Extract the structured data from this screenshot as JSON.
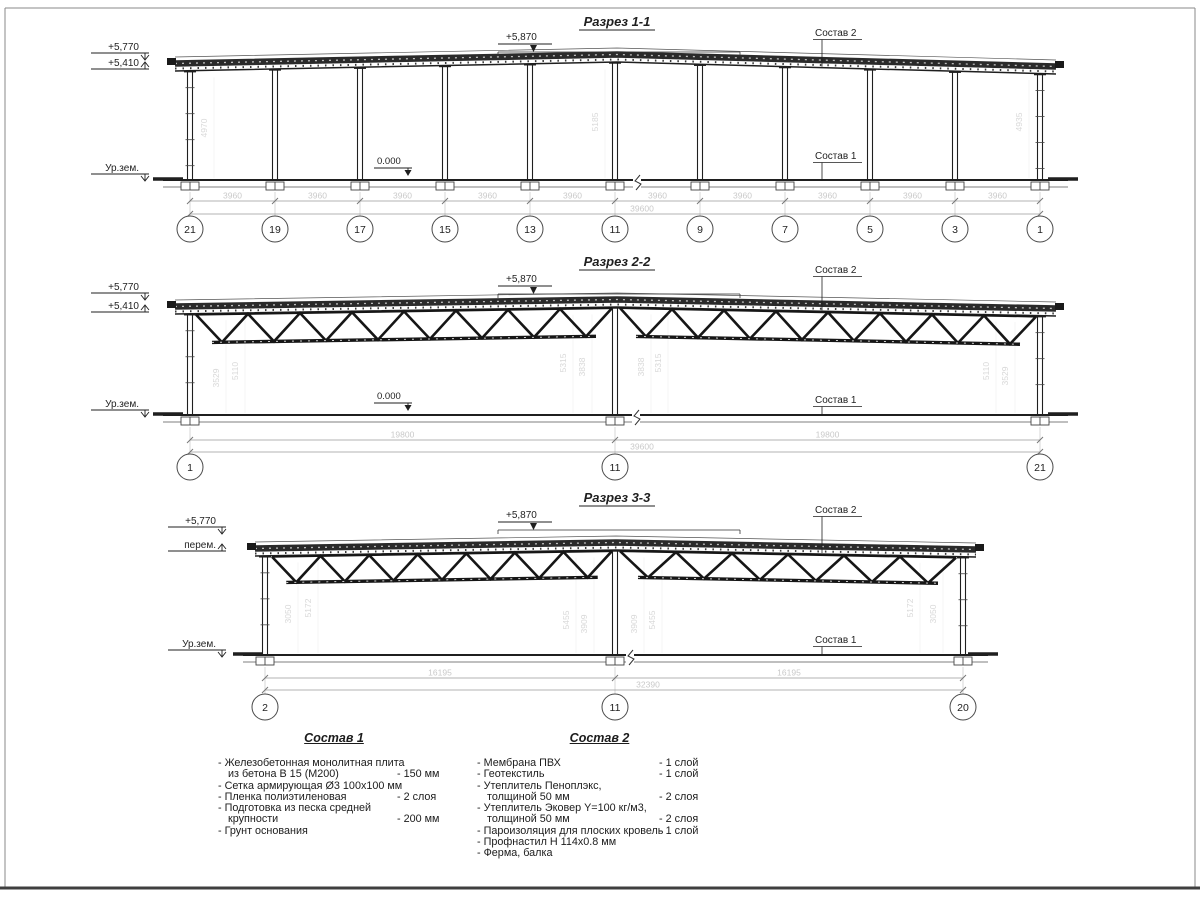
{
  "sheet": {
    "ink": "#1f1f1f",
    "faint": "#c9c9c9",
    "dim_line": "#9a9a9a",
    "background": "#ffffff"
  },
  "sections": [
    {
      "title": "Разрез 1-1",
      "elevations": {
        "top": "+5,770",
        "mid": "+5,410",
        "peak": "+5,870",
        "ground": "Ур.зем.",
        "zero": "0.000"
      },
      "callouts": {
        "roof": "Состав 2",
        "floor": "Состав 1"
      },
      "span_dims": [
        "3960",
        "3960",
        "3960",
        "3960",
        "3960",
        "3960",
        "3960",
        "3960",
        "3960",
        "3960"
      ],
      "total_dim": "39600",
      "height_dims": [
        "4970",
        "5185",
        "4935"
      ],
      "axes": [
        "21",
        "19",
        "17",
        "15",
        "13",
        "11",
        "9",
        "7",
        "5",
        "3",
        "1"
      ]
    },
    {
      "title": "Разрез 2-2",
      "elevations": {
        "top": "+5,770",
        "mid": "+5,410",
        "peak": "+5,870",
        "ground": "Ур.зем.",
        "zero": "0.000"
      },
      "callouts": {
        "roof": "Состав 2",
        "floor": "Состав 1"
      },
      "span_dims": [
        "19800",
        "19800"
      ],
      "total_dim": "39600",
      "height_dims": [
        "3529",
        "5110",
        "5315",
        "3838",
        "3838",
        "5315",
        "5110",
        "3529"
      ],
      "axes": [
        "1",
        "11",
        "21"
      ]
    },
    {
      "title": "Разрез 3-3",
      "elevations": {
        "top": "+5,770",
        "mid": "перем.",
        "peak": "+5,870",
        "ground": "Ур.зем.",
        "zero": ""
      },
      "callouts": {
        "roof": "Состав 2",
        "floor": "Состав 1"
      },
      "span_dims": [
        "16195",
        "16195"
      ],
      "total_dim": "32390",
      "height_dims": [
        "3050",
        "5172",
        "5455",
        "3909",
        "3909",
        "5455",
        "5172",
        "3050"
      ],
      "axes": [
        "2",
        "11",
        "20"
      ]
    }
  ],
  "compositions": [
    {
      "title": "Состав 1",
      "lines": [
        {
          "text": "- Железобетонная  монолитная плита",
          "value": "",
          "cont": false
        },
        {
          "text": "из бетона В 15 (М200)",
          "value": "- 150 мм",
          "cont": true
        },
        {
          "text": "- Сетка армирующая Ø3 100х100 мм",
          "value": "",
          "cont": false
        },
        {
          "text": "- Пленка полиэтиленовая",
          "value": "-  2 слоя",
          "cont": false
        },
        {
          "text": "- Подготовка из песка средней",
          "value": "",
          "cont": false
        },
        {
          "text": "крупности",
          "value": "- 200 мм",
          "cont": true
        },
        {
          "text": "- Грунт основания",
          "value": "",
          "cont": false
        }
      ]
    },
    {
      "title": "Состав 2",
      "lines": [
        {
          "text": "- Мембрана ПВХ",
          "value": "- 1 слой",
          "cont": false
        },
        {
          "text": "- Геотекстиль",
          "value": "- 1 слой",
          "cont": false
        },
        {
          "text": "- Утеплитель Пеноплэкс,",
          "value": "",
          "cont": false
        },
        {
          "text": "толщиной 50 мм",
          "value": "- 2 слоя",
          "cont": true
        },
        {
          "text": "- Утеплитель Эковер Y=100 кг/м3,",
          "value": "",
          "cont": false
        },
        {
          "text": "толщиной 50 мм",
          "value": "- 2 слоя",
          "cont": true
        },
        {
          "text": "- Пароизоляция для плоских кровель",
          "value": "- 1 слой",
          "cont": false
        },
        {
          "text": "- Профнастил Н 114х0.8 мм",
          "value": "",
          "cont": false
        },
        {
          "text": "- Ферма, балка",
          "value": "",
          "cont": false
        }
      ]
    }
  ]
}
